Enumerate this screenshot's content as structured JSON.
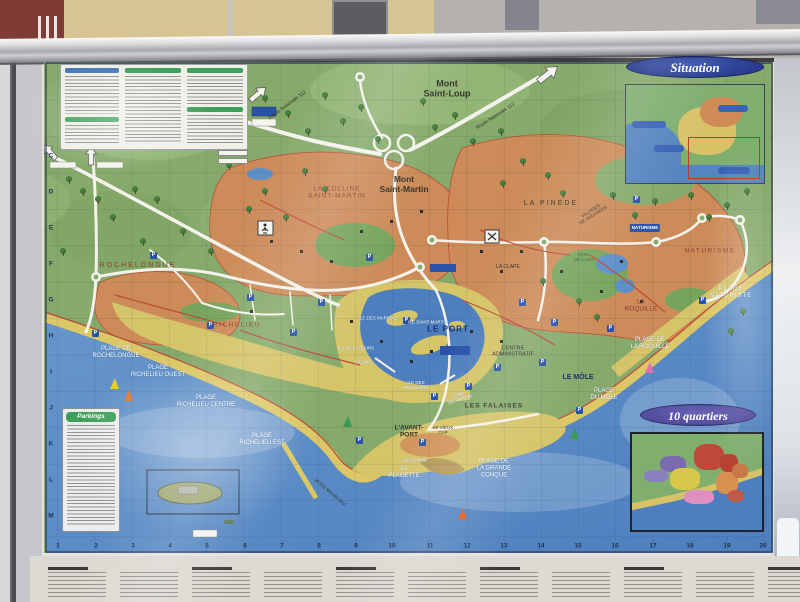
{
  "board": {
    "situation": {
      "title": "Situation"
    },
    "quartiers": {
      "title": "10 quartiers"
    },
    "parkings": {
      "title": "Parkings"
    },
    "parking_glyph": "P",
    "map_colors": {
      "sea": "#5585bf",
      "land": "#86aa6b",
      "urban_orange": "#d08a58",
      "urban_yellow": "#d5c468",
      "sand": "#dcc766",
      "road": "#f4f2ec",
      "road_red": "#bf4a38",
      "grid": "#23477a"
    },
    "labels": [
      {
        "t": "Mont\nSaint-Loup",
        "x": 447,
        "y": 89,
        "cls": "d",
        "s": 9,
        "b": 1
      },
      {
        "t": "Mont\nSaint-Martin",
        "x": 404,
        "y": 185,
        "cls": "d",
        "s": 8.5,
        "b": 1
      },
      {
        "t": "LA COLLINE\nSAINT-MARTIN",
        "x": 337,
        "y": 193,
        "cls": "r",
        "s": 6.5,
        "ls": 1
      },
      {
        "t": "ROCHELONGUE",
        "x": 138,
        "y": 266,
        "cls": "r",
        "s": 7,
        "ls": 2
      },
      {
        "t": "RICHELIEU",
        "x": 237,
        "y": 325,
        "cls": "r",
        "s": 6.5,
        "ls": 1.5
      },
      {
        "t": "LA PINÈDE",
        "x": 551,
        "y": 204,
        "cls": "d",
        "s": 7,
        "ls": 2
      },
      {
        "t": "VILLAGES\nDE VACANCES",
        "x": 592,
        "y": 213,
        "cls": "d",
        "s": 4.5,
        "r": -32
      },
      {
        "t": "PARC\nDE LANO",
        "x": 584,
        "y": 257,
        "cls": "g",
        "s": 4.5
      },
      {
        "t": "LA CLAPE",
        "x": 508,
        "y": 268,
        "cls": "d",
        "s": 5
      },
      {
        "t": "NATURISME",
        "x": 710,
        "y": 251,
        "cls": "r",
        "s": 6.5,
        "ls": 1.5
      },
      {
        "t": "PLAGE\nNATURISTE",
        "x": 731,
        "y": 293,
        "cls": "w",
        "s": 6,
        "ls": 1
      },
      {
        "t": "PLAGE DE\nROCHELONGUE",
        "x": 116,
        "y": 353,
        "cls": "w",
        "s": 6
      },
      {
        "t": "PLAGE\nRICHELIEU OUEST",
        "x": 158,
        "y": 372,
        "cls": "w",
        "s": 6
      },
      {
        "t": "PLAGE\nRICHELIEU CENTRE",
        "x": 206,
        "y": 402,
        "cls": "w",
        "s": 6
      },
      {
        "t": "PLAGE\nRICHELIEU EST",
        "x": 262,
        "y": 440,
        "cls": "w",
        "s": 6
      },
      {
        "t": "LE PORT",
        "x": 448,
        "y": 329,
        "cls": "b",
        "s": 8,
        "b": 1,
        "ls": 1
      },
      {
        "t": "CENTRE\nADMINISTRATIF",
        "x": 513,
        "y": 352,
        "cls": "d",
        "s": 5.5
      },
      {
        "t": "LE MÔLE",
        "x": 578,
        "y": 378,
        "cls": "b",
        "s": 7,
        "b": 1
      },
      {
        "t": "PLAGE\nDU MÔLE",
        "x": 604,
        "y": 395,
        "cls": "w",
        "s": 6
      },
      {
        "t": "LA\nROQUILLE",
        "x": 641,
        "y": 306,
        "cls": "r",
        "s": 6.5
      },
      {
        "t": "PLAGE DE\nLA ROQUILLE",
        "x": 650,
        "y": 344,
        "cls": "w",
        "s": 6
      },
      {
        "t": "LES FALAISES",
        "x": 494,
        "y": 406,
        "cls": "d",
        "s": 6.5,
        "b": 1,
        "ls": 1
      },
      {
        "t": "LE VIEUX\nCAP",
        "x": 443,
        "y": 430,
        "cls": "d",
        "s": 4.5
      },
      {
        "t": "L'AVANT-\nPORT",
        "x": 409,
        "y": 432,
        "cls": "d",
        "s": 6.5,
        "b": 1
      },
      {
        "t": "LA\nPLAGETTE",
        "x": 404,
        "y": 473,
        "cls": "w",
        "s": 6
      },
      {
        "t": "PLAGE DE\nLA GRANDE\nCONQUE",
        "x": 494,
        "y": 469,
        "cls": "w",
        "s": 6
      },
      {
        "t": "ILE DES\nPÊCHEURS",
        "x": 416,
        "y": 385,
        "cls": "w",
        "s": 4.5
      },
      {
        "t": "ILE SAINT-MARTIN",
        "x": 428,
        "y": 322,
        "cls": "w",
        "s": 4.5
      },
      {
        "t": "ILE DES MARINAS",
        "x": 378,
        "y": 318,
        "cls": "w",
        "s": 4.5
      },
      {
        "t": "ILE DES LOISIRS",
        "x": 356,
        "y": 348,
        "cls": "w",
        "s": 4.5
      },
      {
        "t": "CASINO",
        "x": 363,
        "y": 362,
        "cls": "w",
        "s": 4.5
      },
      {
        "t": "ZONE\nTECHNIQUE",
        "x": 459,
        "y": 397,
        "cls": "w",
        "s": 4.5,
        "r": -18
      },
      {
        "t": "AQUARIUM",
        "x": 414,
        "y": 460,
        "cls": "w",
        "s": 4.5
      },
      {
        "t": "JETÉE RICHELIEU",
        "x": 330,
        "y": 492,
        "cls": "d",
        "s": 4.5,
        "r": 40
      },
      {
        "t": "Route Nationale 112",
        "x": 288,
        "y": 106,
        "cls": "d",
        "s": 5,
        "r": -37
      },
      {
        "t": "Route Nationale 112",
        "x": 496,
        "y": 117,
        "cls": "d",
        "s": 5,
        "r": -33
      }
    ],
    "badges": [
      {
        "t": "NATURISME",
        "x": 645,
        "y": 228
      }
    ],
    "grid": {
      "letters": [
        [
          "C",
          156
        ],
        [
          "D",
          192
        ],
        [
          "E",
          228
        ],
        [
          "F",
          264
        ],
        [
          "G",
          300
        ],
        [
          "H",
          336
        ],
        [
          "I",
          372
        ],
        [
          "J",
          408
        ],
        [
          "K",
          444
        ],
        [
          "L",
          480
        ],
        [
          "M",
          516
        ]
      ],
      "numbers": [
        [
          "1",
          58
        ],
        [
          "2",
          96
        ],
        [
          "3",
          133
        ],
        [
          "4",
          170
        ],
        [
          "5",
          207
        ],
        [
          "6",
          245
        ],
        [
          "7",
          282
        ],
        [
          "8",
          319
        ],
        [
          "9",
          356
        ],
        [
          "10",
          392
        ],
        [
          "11",
          430
        ],
        [
          "12",
          467
        ],
        [
          "13",
          504
        ],
        [
          "14",
          541
        ],
        [
          "15",
          578
        ],
        [
          "16",
          615
        ],
        [
          "17",
          653
        ],
        [
          "18",
          690
        ],
        [
          "19",
          727
        ],
        [
          "20",
          763
        ]
      ]
    },
    "icons": {
      "trees": [
        [
          66,
          176
        ],
        [
          80,
          188
        ],
        [
          132,
          186
        ],
        [
          154,
          196
        ],
        [
          226,
          162
        ],
        [
          246,
          206
        ],
        [
          262,
          188
        ],
        [
          283,
          214
        ],
        [
          302,
          168
        ],
        [
          322,
          186
        ],
        [
          262,
          95
        ],
        [
          285,
          110
        ],
        [
          305,
          128
        ],
        [
          322,
          92
        ],
        [
          340,
          118
        ],
        [
          358,
          104
        ],
        [
          375,
          136
        ],
        [
          420,
          98
        ],
        [
          432,
          124
        ],
        [
          452,
          112
        ],
        [
          470,
          138
        ],
        [
          498,
          128
        ],
        [
          520,
          158
        ],
        [
          545,
          172
        ],
        [
          610,
          192
        ],
        [
          632,
          212
        ],
        [
          652,
          198
        ],
        [
          688,
          192
        ],
        [
          706,
          214
        ],
        [
          724,
          202
        ],
        [
          744,
          188
        ],
        [
          95,
          196
        ],
        [
          110,
          214
        ],
        [
          140,
          238
        ],
        [
          180,
          228
        ],
        [
          208,
          248
        ],
        [
          60,
          248
        ],
        [
          540,
          278
        ],
        [
          576,
          298
        ],
        [
          594,
          314
        ],
        [
          740,
          308
        ],
        [
          728,
          328
        ],
        [
          500,
          180
        ],
        [
          560,
          190
        ]
      ],
      "parkings": [
        [
          150,
          252
        ],
        [
          207,
          322
        ],
        [
          247,
          294
        ],
        [
          318,
          299
        ],
        [
          366,
          254
        ],
        [
          403,
          317
        ],
        [
          431,
          393
        ],
        [
          465,
          383
        ],
        [
          519,
          299
        ],
        [
          551,
          319
        ],
        [
          576,
          407
        ],
        [
          607,
          325
        ],
        [
          633,
          196
        ],
        [
          699,
          297
        ],
        [
          419,
          439
        ],
        [
          356,
          437
        ],
        [
          290,
          329
        ],
        [
          494,
          364
        ],
        [
          539,
          359
        ],
        [
          92,
          330
        ]
      ],
      "boats": [
        [
          110,
          378,
          "#e8c83a"
        ],
        [
          124,
          390,
          "#e07830"
        ],
        [
          570,
          428,
          "#3a9a50"
        ],
        [
          645,
          362,
          "#e070b0"
        ],
        [
          458,
          508,
          "#e06028"
        ],
        [
          343,
          416,
          "#3a9a50"
        ]
      ],
      "buildings": [
        [
          270,
          240
        ],
        [
          300,
          250
        ],
        [
          330,
          260
        ],
        [
          360,
          230
        ],
        [
          390,
          220
        ],
        [
          420,
          210
        ],
        [
          480,
          250
        ],
        [
          500,
          270
        ],
        [
          520,
          250
        ],
        [
          560,
          270
        ],
        [
          600,
          290
        ],
        [
          620,
          260
        ],
        [
          640,
          300
        ],
        [
          500,
          340
        ],
        [
          470,
          330
        ],
        [
          430,
          350
        ],
        [
          410,
          360
        ],
        [
          380,
          340
        ],
        [
          350,
          320
        ],
        [
          250,
          310
        ]
      ]
    }
  }
}
